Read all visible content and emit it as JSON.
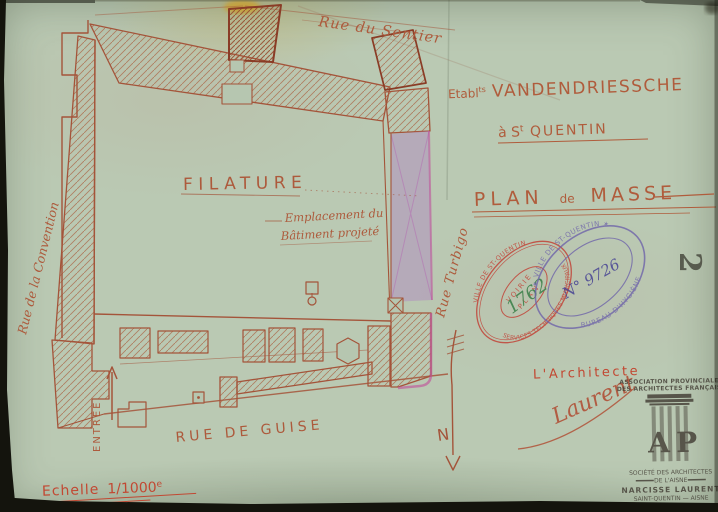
{
  "sheet": {
    "streets": {
      "top": "Rue du Sentier",
      "left": "Rue de la Convention",
      "right": "Rue Turbigo",
      "bottom": "RUE DE GUISE"
    },
    "plan": {
      "building_label": "FILATURE",
      "annotation_line1": "Emplacement du",
      "annotation_line2": "Bâtiment projeté",
      "entrance_label": "ENTRÉE",
      "north_label": "N"
    },
    "titleblock": {
      "estab_prefix": "Etabl",
      "estab_sup": "ts",
      "company": "VANDENDRIESSCHE",
      "city_pre": "à S",
      "city_sup": "t",
      "city_post": " QUENTIN",
      "plan_word1": "PLAN",
      "plan_word2": "de",
      "plan_word3": "MASSE"
    },
    "scale": {
      "label": "Echelle",
      "value": "1/1000",
      "sup": "e"
    },
    "architect": {
      "heading": "L'Architecte",
      "signature": "Laurent"
    },
    "sheet_number": "2"
  },
  "stamps": {
    "voirie": {
      "ring_top": "VILLE DE ST-QUENTIN",
      "ring_bottom": "SERVICES TECHNIQUES MUNICIPAUX",
      "center_line1": "VOIRIE",
      "center_line2": "PLAN",
      "number": "1762"
    },
    "hygiene": {
      "ring_top": "✶ VILLE DE ST-QUENTIN ✶",
      "ring_bottom": "BUREAU D'HYGIÈNE",
      "number": "N° 9726"
    },
    "association": {
      "line1": "ASSOCIATION PROVINCIALE",
      "line2": "DES ARCHITECTES FRANÇAIS",
      "logo_letter_a": "A",
      "logo_letter_p": "P",
      "line3": "SOCIÉTÉ DES ARCHITECTES",
      "line4": "DE L'AISNE",
      "line5": "NARCISSE LAURENT",
      "line6": "SAINT-QUENTIN — AISNE"
    }
  },
  "colors": {
    "paper": "#b3c4ad",
    "ink_sienna": "#a4543a",
    "ink_red": "#c24832",
    "stamp_red": "#c23b30",
    "stamp_green": "#2f7a3f",
    "stamp_purple": "#6f64aa",
    "stamp_black": "#474239",
    "projected_violet": "#b084c2"
  }
}
